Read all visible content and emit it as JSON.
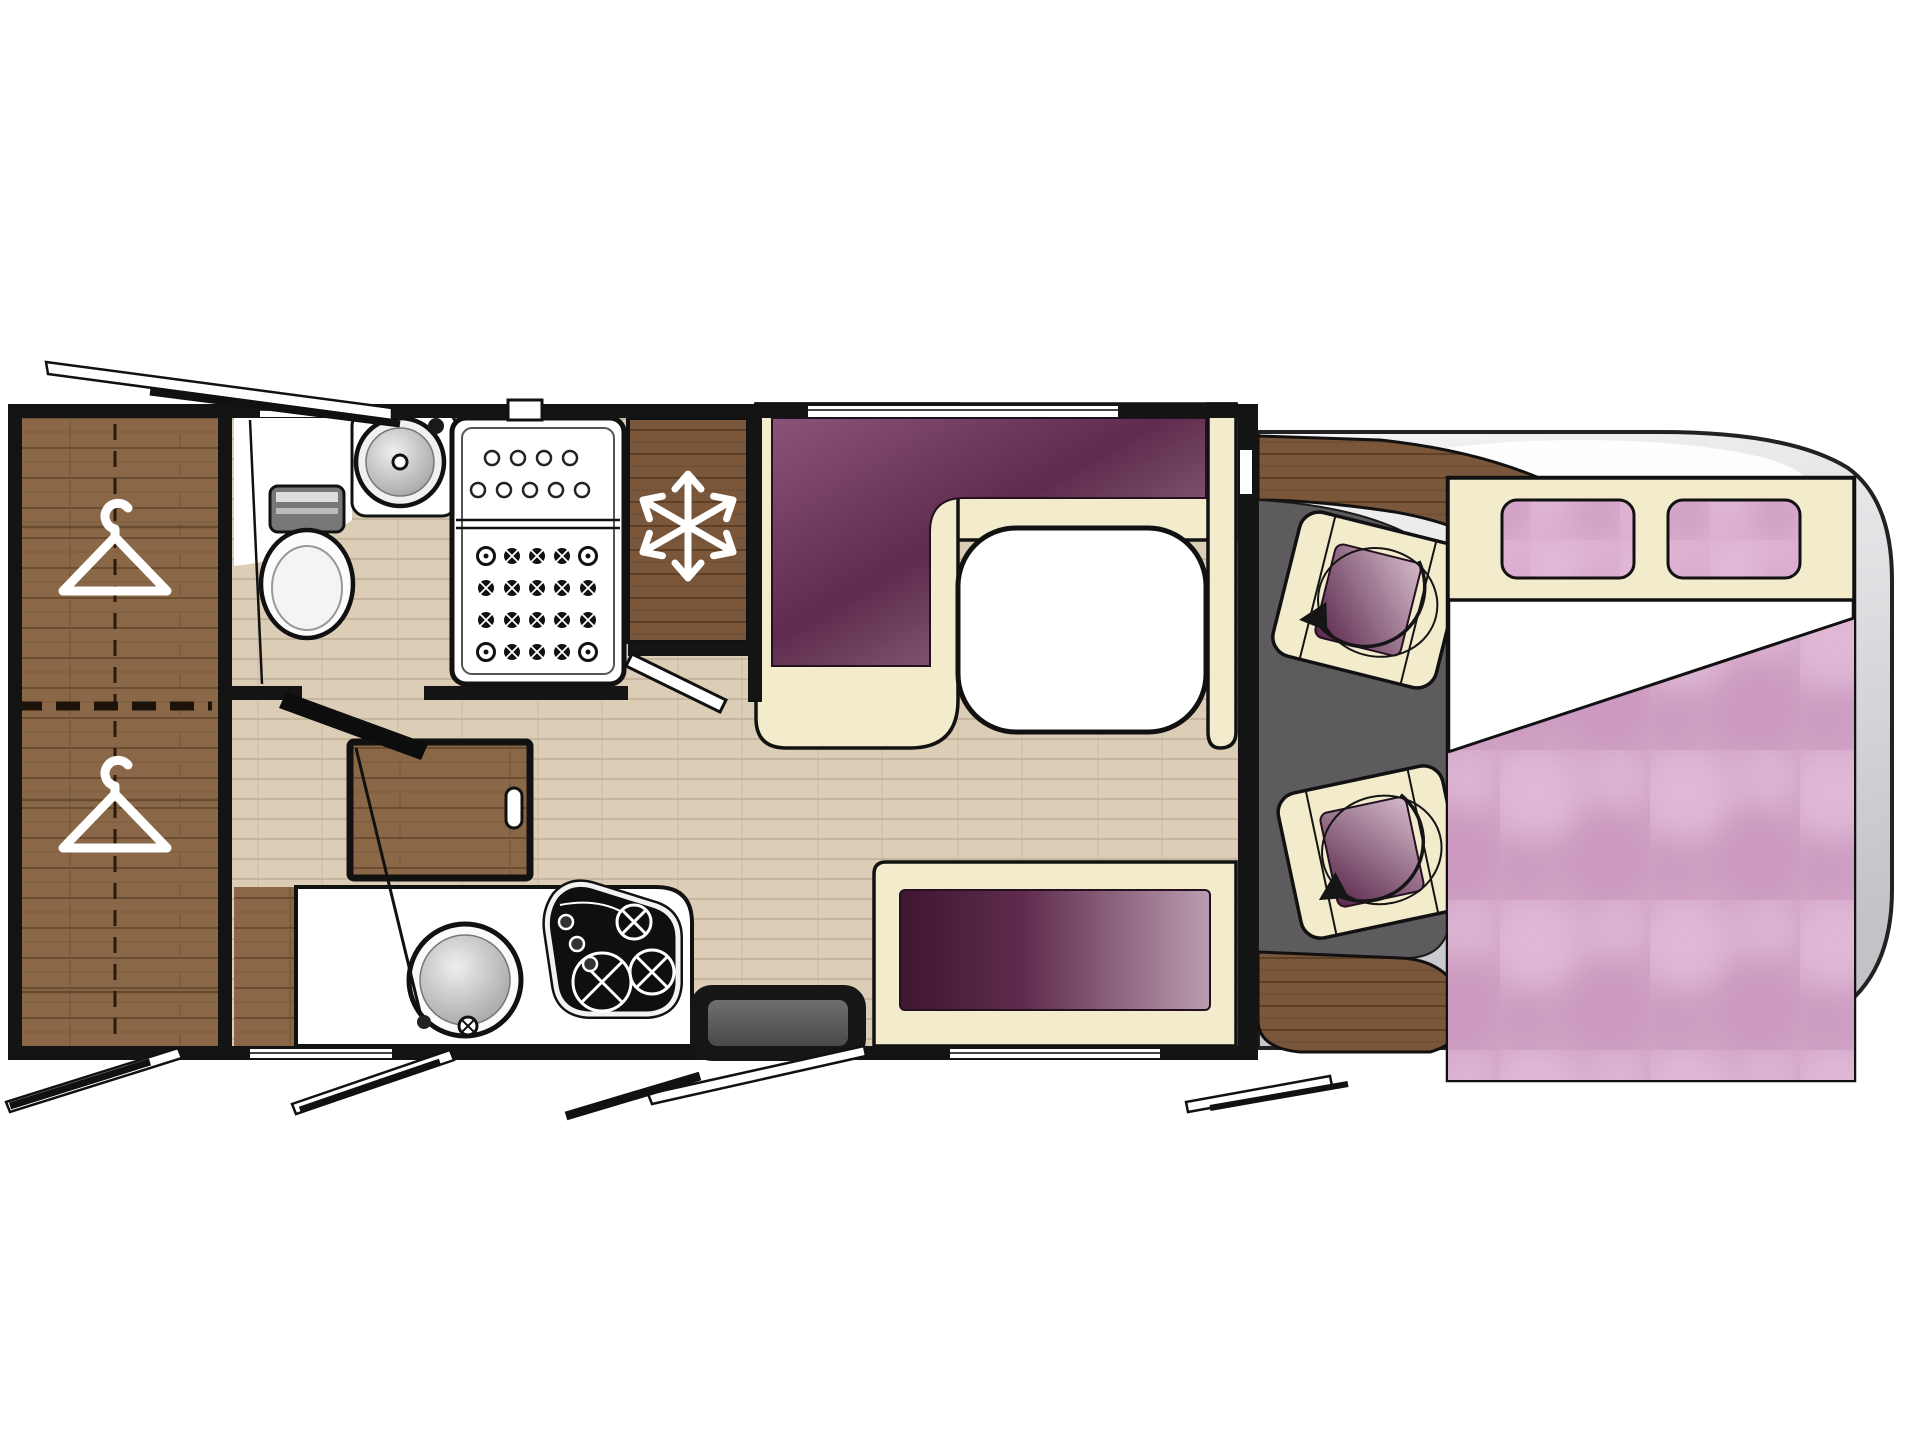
{
  "meta": {
    "title": "Motorhome floor plan — top view"
  },
  "colors": {
    "wall": "#141414",
    "outline": "#111111",
    "white": "#ffffff",
    "floor-base": "#dccdb6",
    "floor-line": "#c6b69e",
    "wood-base": "#8a6847",
    "wood-line": "#6b4d32",
    "wood-dark-base": "#7a573a",
    "wood-dark-line": "#5e4027",
    "cream": "#f2ebcc",
    "plum-dark": "#5f2c4d",
    "plum-mid": "#8a5478",
    "plum-light": "#a98a9e",
    "bench-dark": "#401631",
    "bench-light": "#bb9db0",
    "cushion-dark": "#58254a",
    "cushion-light": "#d4bac9",
    "pink-base": "#d2a4c7",
    "pink-lite": "#e3bcd8",
    "pink-deep": "#c794bb",
    "pillow-base": "#ddb0d2",
    "body-light": "#f5f5f7",
    "body-dark": "#c2c2c7",
    "cab-floor": "#5d5b5d",
    "step-fill": "#161616",
    "step-inner": "#5a5a5a"
  },
  "zones": {
    "wardrobe": {
      "label": "Wardrobe with clothes hangers",
      "icon": "hanger-icon",
      "hangers": 2
    },
    "washroom": {
      "label": "Washroom with toilet and basin"
    },
    "shower": {
      "label": "Shower cubicle"
    },
    "fridge": {
      "label": "Refrigerator",
      "icon": "snowflake-icon"
    },
    "dinette": {
      "label": "L-shaped dinette with pedestal table"
    },
    "bench": {
      "label": "Side bench seat"
    },
    "kitchen": {
      "label": "Kitchen with sink and 3-burner hob",
      "hob_burners": 3
    },
    "entry": {
      "label": "Entry step"
    },
    "cab": {
      "label": "Driver cab with two swivel seats",
      "icon": "rotation-arrow-icon",
      "swivel_seats": 2
    },
    "bed": {
      "label": "Drop-down double bed",
      "pillows": 2
    },
    "exterior": {
      "label": "Vehicle body with opened windows",
      "open_windows": 5
    }
  }
}
